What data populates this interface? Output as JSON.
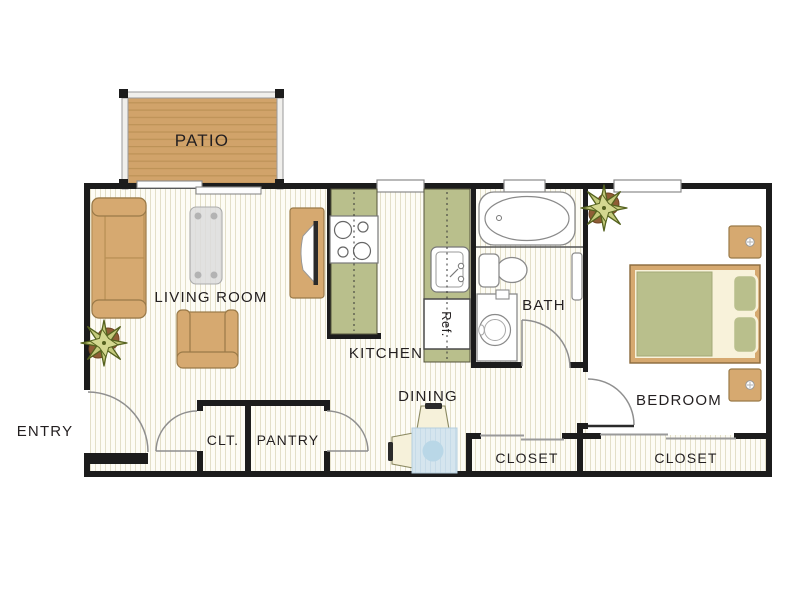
{
  "labels": {
    "patio": "PATIO",
    "living_room": "LIVING ROOM",
    "kitchen": "KITCHEN",
    "bath": "BATH",
    "dining": "DINING",
    "bedroom": "BEDROOM",
    "entry": "ENTRY",
    "clt": "CLT.",
    "pantry": "PANTRY",
    "closet_hall": "CLOSET",
    "closet_bedroom": "CLOSET",
    "fridge": "Ref."
  },
  "colors": {
    "wall": "#1c1c1c",
    "furniture_tan": "#d6a970",
    "furniture_tan_stroke": "#9a7a48",
    "counter_olive": "#b9bf8c",
    "deck_tan": "#d1a36a",
    "deck_plank_line": "#bd9257",
    "floor_stripe": "#e3dfc8",
    "cream": "#f8f2da",
    "dining_blue": "#d5e5ee",
    "dining_blue_circle": "#b9d7e7",
    "text": "#231f20",
    "fixture_stroke": "#8a8a8a"
  }
}
